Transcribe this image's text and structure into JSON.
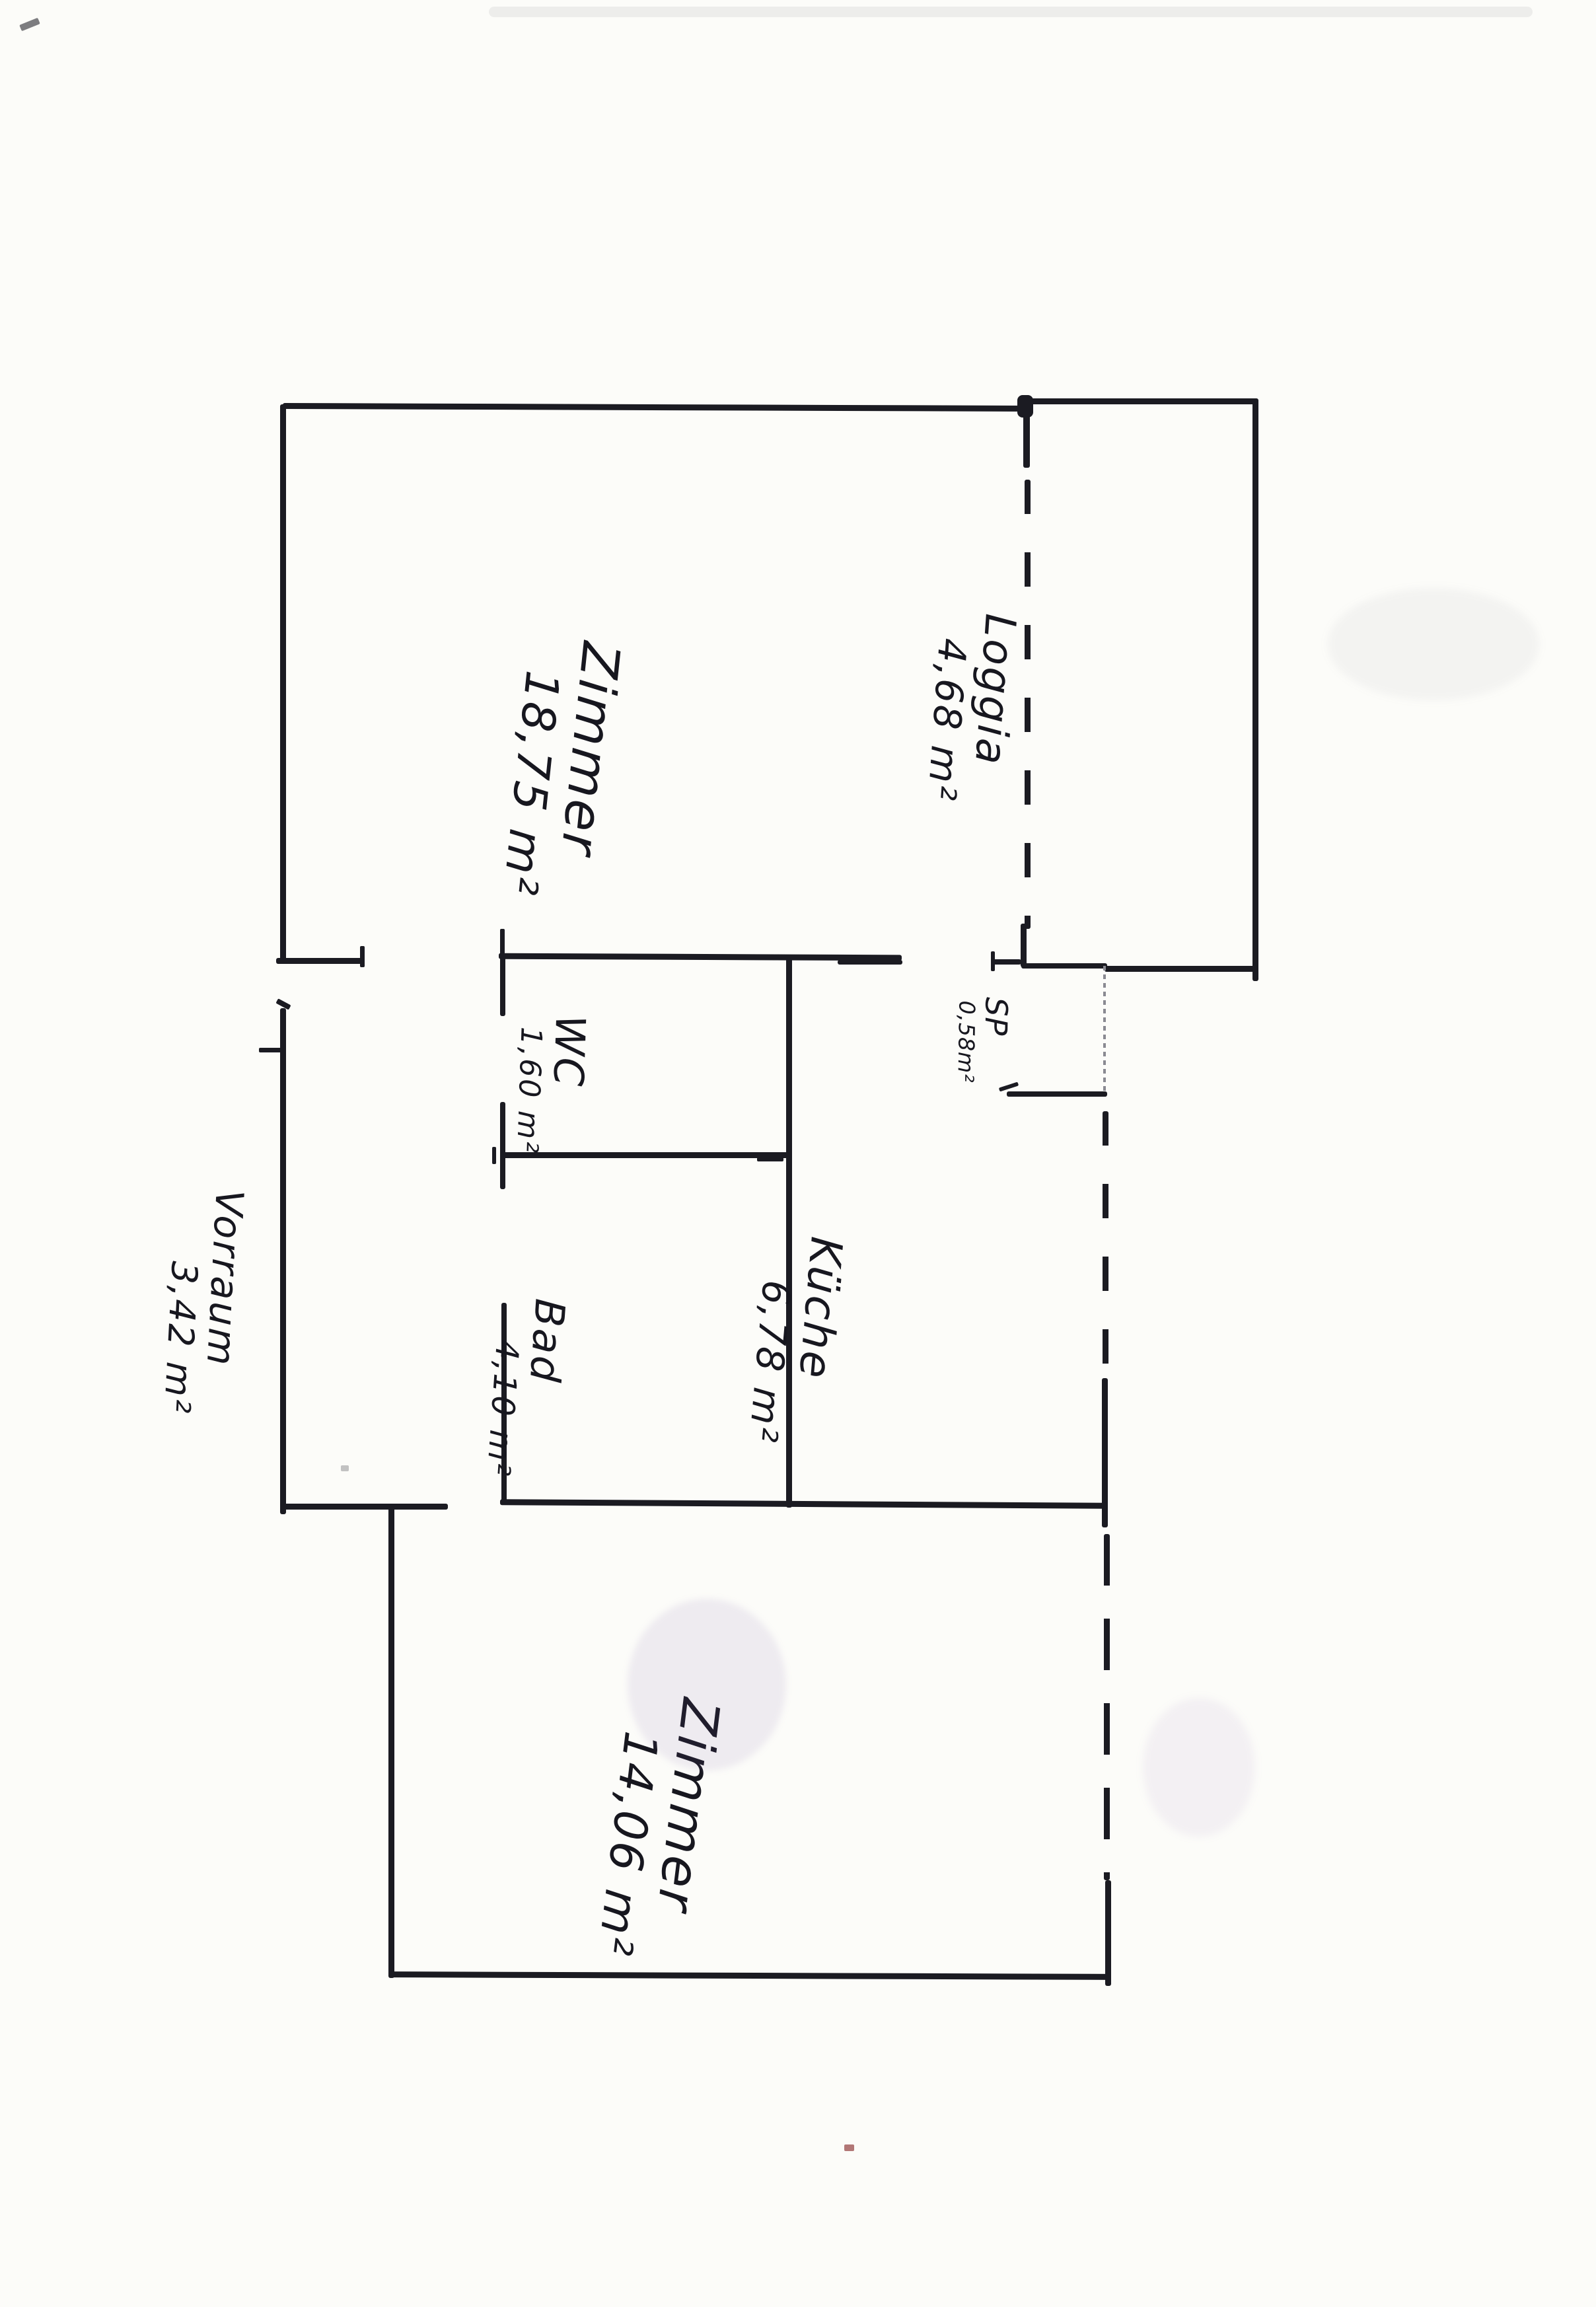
{
  "document": {
    "kind": "hand-drawn floor plan (scanned sketch)",
    "language": "de",
    "orientation_note": "all room labels written rotated 90° clockwise"
  },
  "colors": {
    "ink": "#1b1b22",
    "paper": "#fcfcf9",
    "faint_wall": "#8a8a92",
    "smudge_purple": "#7a55a8",
    "speck_red": "#8a3030"
  },
  "rooms": [
    {
      "id": "zimmer-top",
      "name": "Zimmer",
      "area": "18,75 m²"
    },
    {
      "id": "loggia",
      "name": "Loggia",
      "area": "4,68 m²"
    },
    {
      "id": "wc",
      "name": "WC",
      "area": "1,60 m²"
    },
    {
      "id": "sp",
      "name": "SP",
      "area": "0,58m²"
    },
    {
      "id": "kueche",
      "name": "Küche",
      "area": "6,78 m²"
    },
    {
      "id": "bad",
      "name": "Bad",
      "area": "4,10 m²"
    },
    {
      "id": "vorraum",
      "name": "Vorraum",
      "area": "3,42 m²"
    },
    {
      "id": "zimmer-bottom",
      "name": "Zimmer",
      "area": "14,06 m²"
    }
  ]
}
